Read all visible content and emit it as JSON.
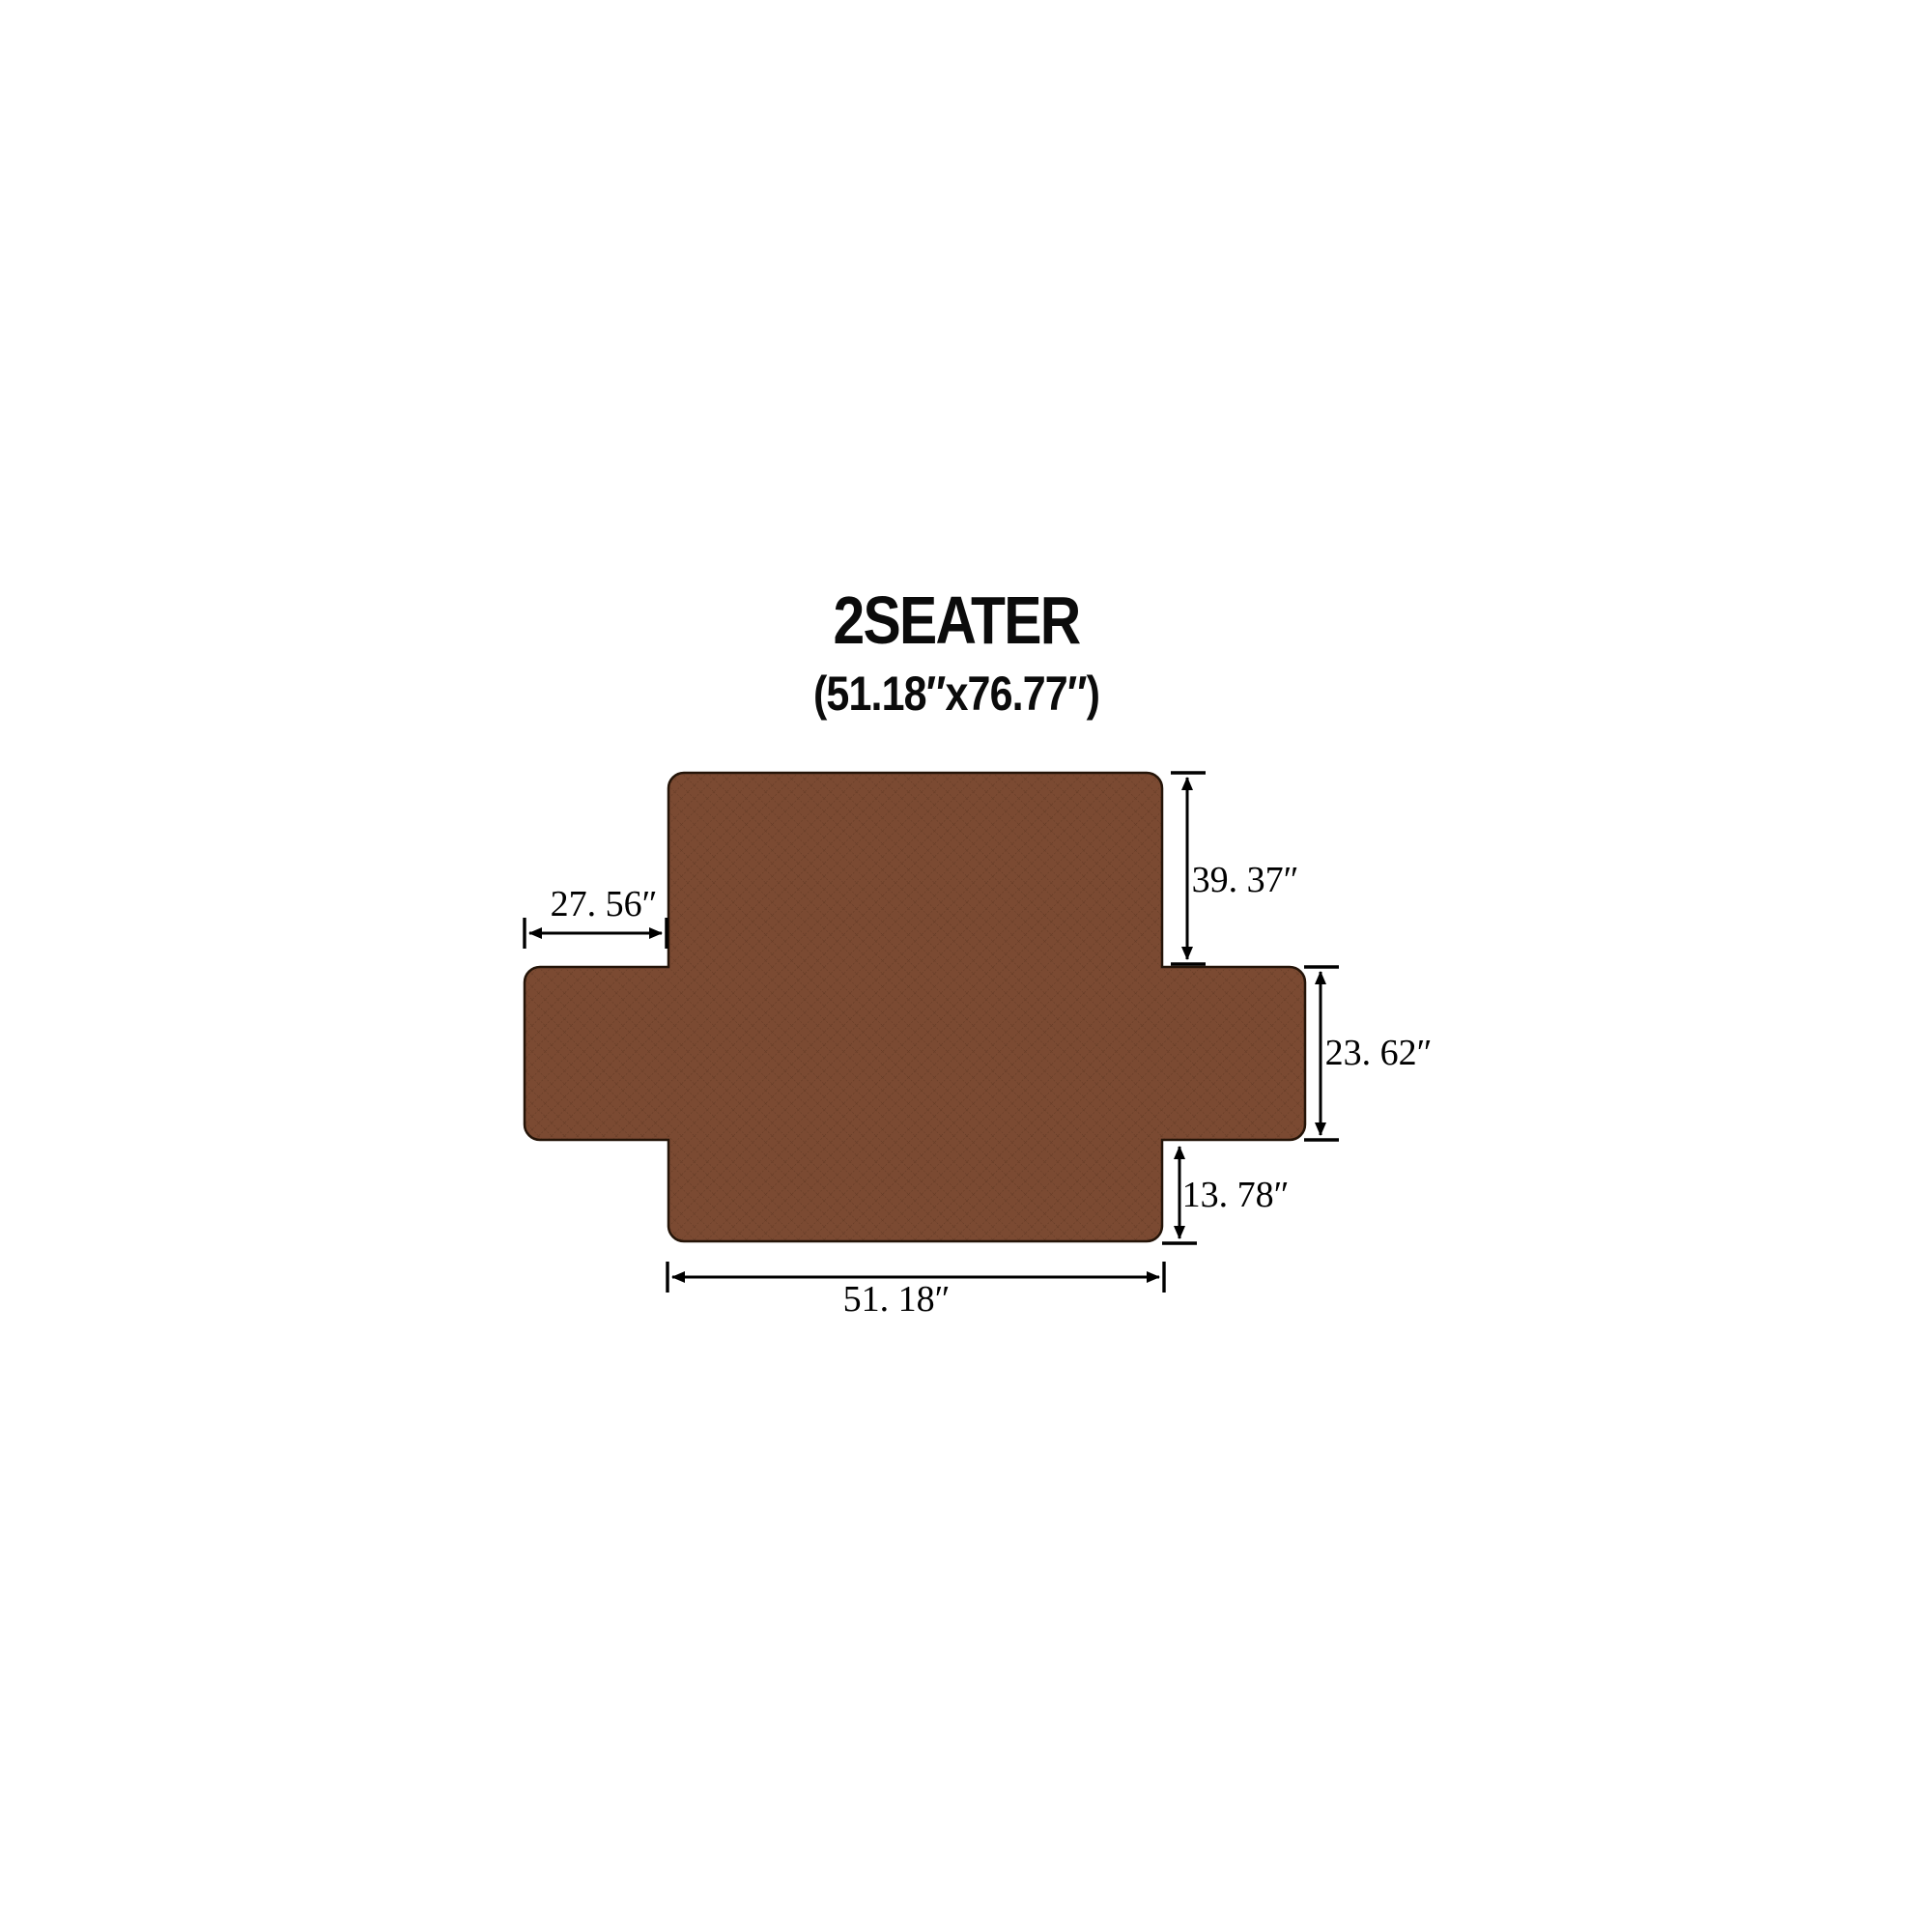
{
  "title": {
    "text": "2SEATER",
    "size_note": "(51.18″x76.77″)"
  },
  "cover": {
    "name": "2-seater sofa cover (quilted, top view)",
    "fill_color": "#7b4a32",
    "pattern_color": "#4f2d1a",
    "outline_color": "#241408",
    "background_color": "#ffffff",
    "annotation_color": "#000000"
  },
  "dimensions": {
    "back_height": {
      "label": "39. 37″",
      "inches": 39.37
    },
    "arm_flap": {
      "label": "27. 56″",
      "inches": 27.56
    },
    "side_drop": {
      "label": "23. 62″",
      "inches": 23.62
    },
    "front_drop": {
      "label": "13. 78″",
      "inches": 13.78
    },
    "seat_width": {
      "label": "51. 18″",
      "inches": 51.18
    }
  }
}
